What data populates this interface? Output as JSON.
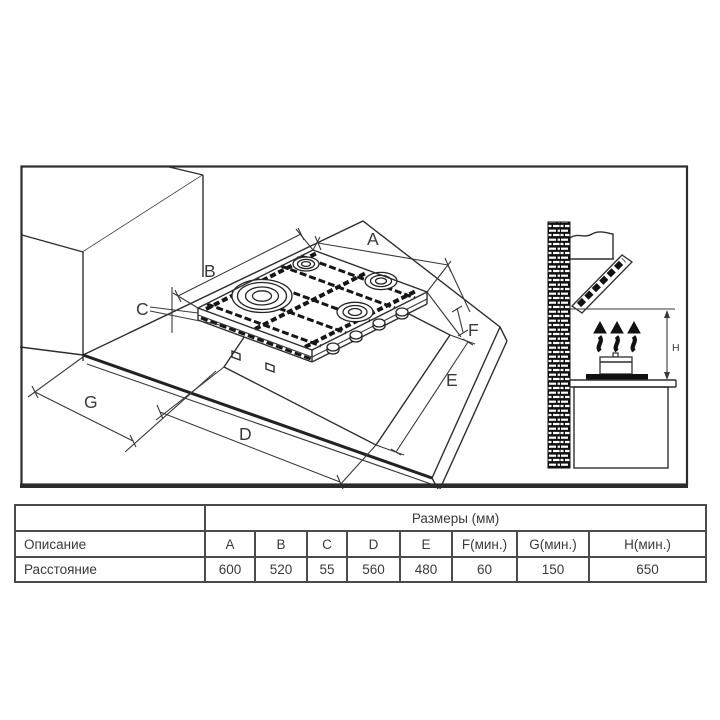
{
  "diagram": {
    "dim_labels": {
      "A": "A",
      "B": "B",
      "C": "C",
      "D": "D",
      "E": "E",
      "F": "F",
      "G": "G",
      "H": "H"
    }
  },
  "table": {
    "group_header": "Размеры (мм)",
    "description_label": "Описание",
    "distance_label": "Расстояние",
    "columns": [
      "A",
      "B",
      "C",
      "D",
      "E",
      "F(мин.)",
      "G(мин.)",
      "H(мин.)"
    ],
    "values": [
      "600",
      "520",
      "55",
      "560",
      "480",
      "60",
      "150",
      "650"
    ]
  }
}
